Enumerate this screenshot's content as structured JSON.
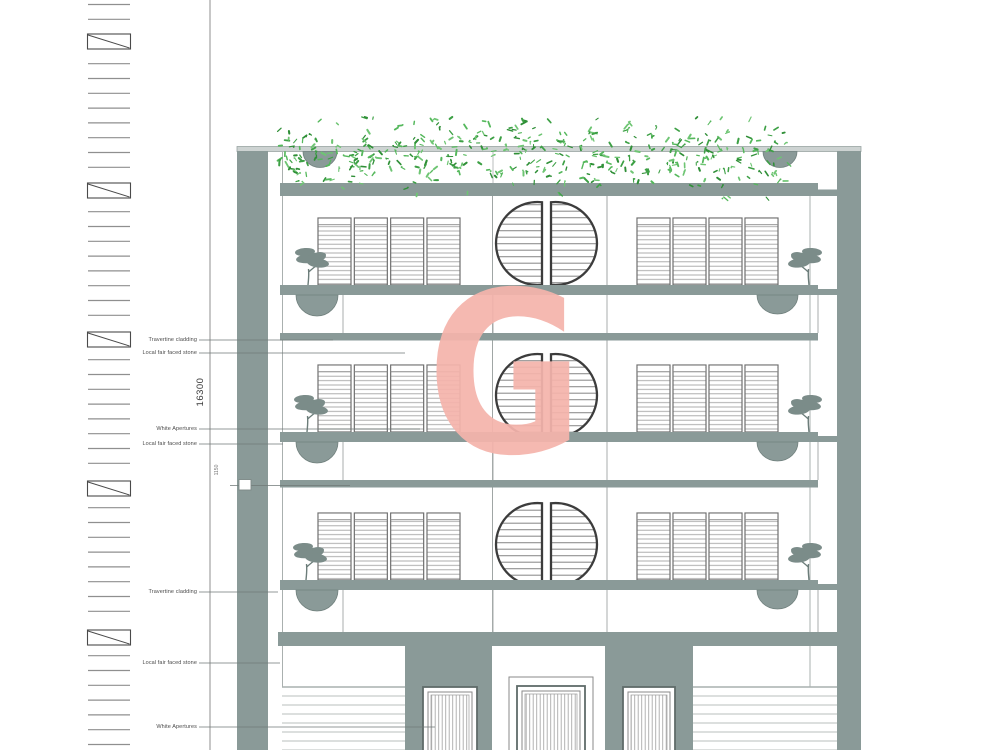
{
  "page": {
    "type": "architectural-front-elevation",
    "background": "#ffffff"
  },
  "watermark": {
    "letter": "G",
    "color": "#f5b4ac"
  },
  "dimensions": {
    "overall_height": "16300",
    "detail": "1150"
  },
  "material_labels": [
    {
      "text": "Travertine cladding",
      "y": 340,
      "line_end_x": 333
    },
    {
      "text": "Local fair faced stone",
      "y": 353,
      "line_end_x": 405
    },
    {
      "text": "White Apertures",
      "y": 429,
      "line_end_x": 420
    },
    {
      "text": "Local fair faced stone",
      "y": 444,
      "line_end_x": 283
    },
    {
      "text": "Travertine cladding",
      "y": 592,
      "line_end_x": 278
    },
    {
      "text": "Local fair faced stone",
      "y": 663,
      "line_end_x": 280
    },
    {
      "text": "White Apertures",
      "y": 727,
      "line_end_x": 435
    }
  ],
  "elevation": {
    "storeys": 3,
    "shutter_panels_per_window": 4,
    "circular_windows": 3,
    "entrance_doors": 3,
    "colors": {
      "sage": "#8a9a98",
      "sage_dark": "#72827f",
      "tree_foliage": "#7b8c89",
      "line_gray": "#9aa19f",
      "dashed_line": "#3f3f3f",
      "stripe": "#b9bfbe",
      "vegetation": [
        "#3da045",
        "#55b85c",
        "#2f8f37",
        "#6ec573"
      ]
    }
  }
}
